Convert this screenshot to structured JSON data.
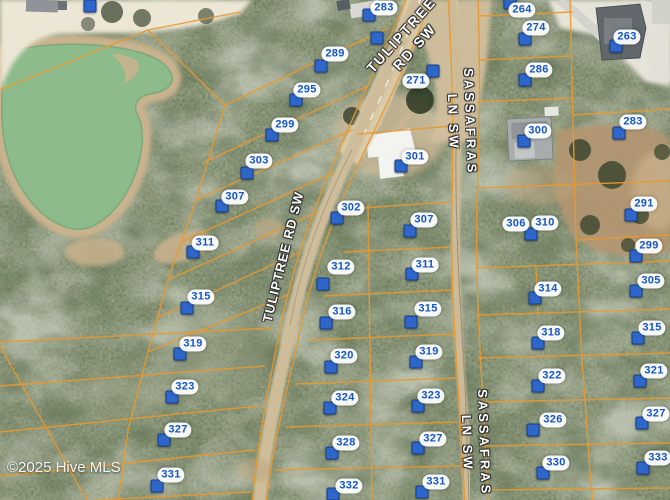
{
  "map": {
    "watermark": "©2025 Hive MLS",
    "road_labels": [
      {
        "id": "tuliptree-top",
        "lines": [
          "TULIPTREE",
          "RD SW"
        ],
        "x": 408,
        "y": 41,
        "rotate": -48,
        "size": 14
      },
      {
        "id": "tuliptree-mid",
        "lines": [
          "TULIPTREE RD SW"
        ],
        "x": 284,
        "y": 257,
        "rotate": -76,
        "size": 13
      },
      {
        "id": "sassafras-top",
        "lines": [
          "SASSAFRAS",
          "LN SW"
        ],
        "x": 461,
        "y": 122,
        "rotate": 88,
        "size": 13
      },
      {
        "id": "sassafras-bottom",
        "lines": [
          "SASSAFRAS",
          "LN SW"
        ],
        "x": 475,
        "y": 443,
        "rotate": 88,
        "size": 13
      }
    ],
    "parcels": [
      {
        "label": "283",
        "lx": 384,
        "ly": 8,
        "px": 369,
        "py": 15
      },
      {
        "label": "289",
        "lx": 335,
        "ly": 54,
        "px": 321,
        "py": 66
      },
      {
        "label": "295",
        "lx": 307,
        "ly": 90,
        "px": 296,
        "py": 100
      },
      {
        "label": "299",
        "lx": 285,
        "ly": 125,
        "px": 272,
        "py": 135
      },
      {
        "label": "303",
        "lx": 259,
        "ly": 161,
        "px": 247,
        "py": 173
      },
      {
        "label": "307",
        "lx": 235,
        "ly": 197,
        "px": 222,
        "py": 206
      },
      {
        "label": "311",
        "lx": 205,
        "ly": 243,
        "px": 193,
        "py": 252
      },
      {
        "label": "315",
        "lx": 201,
        "ly": 297,
        "px": 187,
        "py": 308
      },
      {
        "label": "319",
        "lx": 193,
        "ly": 344,
        "px": 180,
        "py": 354
      },
      {
        "label": "323",
        "lx": 185,
        "ly": 387,
        "px": 172,
        "py": 397
      },
      {
        "label": "327",
        "lx": 178,
        "ly": 430,
        "px": 164,
        "py": 440
      },
      {
        "label": "331",
        "lx": 171,
        "ly": 475,
        "px": 157,
        "py": 486
      },
      {
        "label": "302",
        "lx": 351,
        "ly": 208,
        "px": 337,
        "py": 218
      },
      {
        "label": "312",
        "lx": 341,
        "ly": 267,
        "px": 323,
        "py": 284
      },
      {
        "label": "316",
        "lx": 342,
        "ly": 312,
        "px": 326,
        "py": 323
      },
      {
        "label": "320",
        "lx": 344,
        "ly": 356,
        "px": 331,
        "py": 367
      },
      {
        "label": "324",
        "lx": 345,
        "ly": 398,
        "px": 330,
        "py": 408
      },
      {
        "label": "328",
        "lx": 346,
        "ly": 443,
        "px": 332,
        "py": 453
      },
      {
        "label": "332",
        "lx": 349,
        "ly": 486,
        "px": 333,
        "py": 494
      },
      {
        "label": "271",
        "lx": 416,
        "ly": 81,
        "px": 433,
        "py": 71
      },
      {
        "label": "301",
        "lx": 415,
        "ly": 157,
        "px": 401,
        "py": 166
      },
      {
        "label": "307",
        "lx": 424,
        "ly": 220,
        "px": 410,
        "py": 231
      },
      {
        "label": "311",
        "lx": 425,
        "ly": 265,
        "px": 412,
        "py": 274
      },
      {
        "label": "315",
        "lx": 428,
        "ly": 309,
        "px": 411,
        "py": 322
      },
      {
        "label": "319",
        "lx": 429,
        "ly": 352,
        "px": 416,
        "py": 362
      },
      {
        "label": "323",
        "lx": 431,
        "ly": 396,
        "px": 418,
        "py": 406
      },
      {
        "label": "327",
        "lx": 433,
        "ly": 439,
        "px": 418,
        "py": 448
      },
      {
        "label": "331",
        "lx": 436,
        "ly": 482,
        "px": 422,
        "py": 492
      },
      {
        "label": "264",
        "lx": 522,
        "ly": 10,
        "px": 510,
        "py": 3
      },
      {
        "label": "274",
        "lx": 536,
        "ly": 28,
        "px": 525,
        "py": 39
      },
      {
        "label": "286",
        "lx": 539,
        "ly": 70,
        "px": 525,
        "py": 80
      },
      {
        "label": "300",
        "lx": 538,
        "ly": 131,
        "px": 524,
        "py": 141
      },
      {
        "label": "306",
        "lx": 516,
        "ly": 224,
        "px": 531,
        "py": 234
      },
      {
        "label": "310",
        "lx": 545,
        "ly": 223,
        "px": null,
        "py": null
      },
      {
        "label": "314",
        "lx": 548,
        "ly": 289,
        "px": 535,
        "py": 298
      },
      {
        "label": "318",
        "lx": 551,
        "ly": 333,
        "px": 538,
        "py": 343
      },
      {
        "label": "322",
        "lx": 552,
        "ly": 376,
        "px": 538,
        "py": 386
      },
      {
        "label": "326",
        "lx": 553,
        "ly": 420,
        "px": 533,
        "py": 430
      },
      {
        "label": "330",
        "lx": 556,
        "ly": 463,
        "px": 543,
        "py": 473
      },
      {
        "label": "263",
        "lx": 627,
        "ly": 37,
        "px": 616,
        "py": 46
      },
      {
        "label": "283",
        "lx": 633,
        "ly": 122,
        "px": 619,
        "py": 133
      },
      {
        "label": "291",
        "lx": 644,
        "ly": 204,
        "px": 631,
        "py": 215
      },
      {
        "label": "299",
        "lx": 649,
        "ly": 246,
        "px": 636,
        "py": 256
      },
      {
        "label": "305",
        "lx": 651,
        "ly": 281,
        "px": 636,
        "py": 291
      },
      {
        "label": "315",
        "lx": 652,
        "ly": 328,
        "px": 638,
        "py": 338
      },
      {
        "label": "321",
        "lx": 654,
        "ly": 371,
        "px": 640,
        "py": 381
      },
      {
        "label": "327",
        "lx": 656,
        "ly": 414,
        "px": 642,
        "py": 423
      },
      {
        "label": "333",
        "lx": 658,
        "ly": 458,
        "px": 643,
        "py": 468
      }
    ],
    "extra_pins": [
      {
        "x": 377,
        "y": 38
      },
      {
        "x": 90,
        "y": 6
      }
    ]
  },
  "colors": {
    "pin": "#2e66c9",
    "pin-border": "#17408c",
    "label-text": "#1456c8",
    "parcel-line": "#e8992f",
    "pond": "#8cbb8a",
    "pond-shore": "#c9b28c",
    "road-sand": "#cfbd99",
    "forest": "#46513a"
  }
}
